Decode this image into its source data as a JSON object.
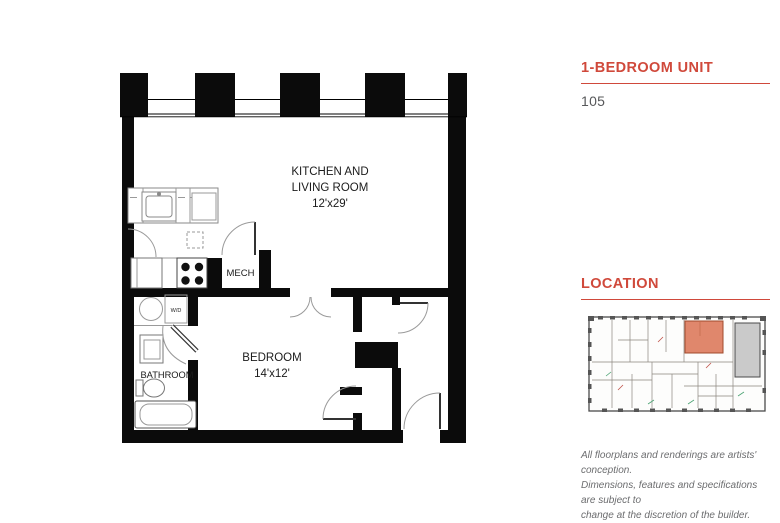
{
  "sidebar": {
    "unit_type_title": "1-BEDROOM UNIT",
    "unit_number": "105",
    "location_title": "LOCATION",
    "disclaimer_lines": [
      "All floorplans and renderings are artists' conception.",
      "Dimensions, features and specifications are subject to",
      "change at the discretion of the builder."
    ]
  },
  "floorplan": {
    "rooms": [
      {
        "name": "kitchen-living",
        "label_lines": [
          "KITCHEN AND",
          "LIVING ROOM"
        ],
        "dimensions": "12'x29'"
      },
      {
        "name": "bedroom",
        "label_lines": [
          "BEDROOM"
        ],
        "dimensions": "14'x12'"
      },
      {
        "name": "mech",
        "label": "MECH"
      },
      {
        "name": "bathroom",
        "label": "BATHROOM"
      },
      {
        "name": "laundry",
        "label": "W/D"
      }
    ]
  },
  "colors": {
    "accent": "#d0493b",
    "wall": "#0b0b0b",
    "map_highlight": "#e0876c",
    "map_highlight_border": "#a14a2c",
    "map_building_block": "#cacaca"
  }
}
